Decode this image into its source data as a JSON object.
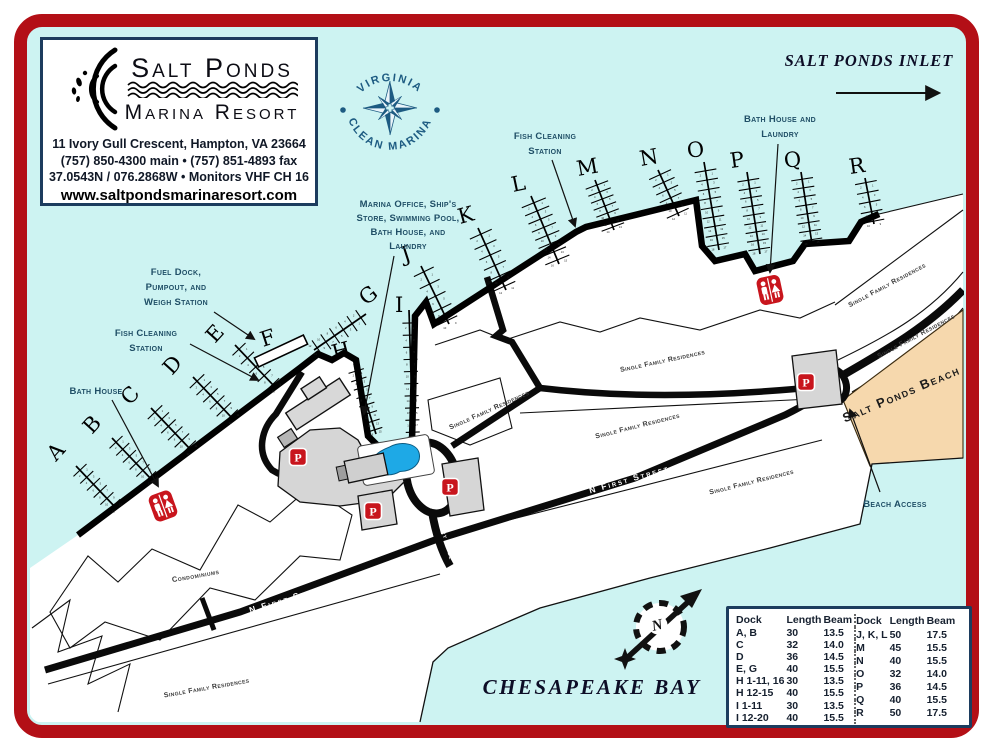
{
  "colors": {
    "frame_red": "#b30f16",
    "navy_border": "#1c3c5e",
    "water": "#cdf3f2",
    "label_blue": "#1f4e66",
    "beach_tan": "#f6d8ad",
    "clean_marina_blue": "#1d5b82",
    "icon_red": "#c8151d",
    "pool_blue": "#1ea9e6"
  },
  "logo_box": {
    "name_line1": "Salt Ponds",
    "name_line2": "Marina Resort",
    "address": "11 Ivory Gull Crescent, Hampton, VA  23664",
    "phone": "(757) 850-4300 main • (757) 851-4893 fax",
    "coordinates": "37.0543N / 076.2868W • Monitors VHF CH 16",
    "website": "www.saltpondsmarinaresort.com"
  },
  "clean_marina": {
    "arc_top": "VIRGINIA",
    "arc_bottom": "CLEAN MARINA"
  },
  "sea_labels": {
    "inlet": "SALT PONDS INLET",
    "bay": "CHESAPEAKE BAY",
    "compass_north": "N"
  },
  "annotations": {
    "fish_cleaning_line1": "Fish Cleaning",
    "fish_cleaning_line2": "Station",
    "bath_laundry_line1": "Bath House and",
    "bath_laundry_line2": "Laundry",
    "marina_office_line1": "Marina Office, Ship's",
    "marina_office_line2": "Store, Swimming Pool,",
    "marina_office_line3": "Bath House, and",
    "marina_office_line4": "Laundry",
    "fuel_line1": "Fuel Dock,",
    "fuel_line2": "Pumpout, and",
    "fuel_line3": "Weigh Station",
    "bath_house": "Bath House",
    "beach_access": "Beach Access"
  },
  "area_labels": {
    "beach": "Salt Ponds Beach",
    "condominiums": "Condominiums",
    "single_family": "Single Family Residences",
    "n_first_street": "N First Street",
    "ivory_gull": "Ivory Gull"
  },
  "icons": {
    "parking_label": "P"
  },
  "docks": [
    {
      "id": "A",
      "slips": 12
    },
    {
      "id": "B",
      "slips": 12
    },
    {
      "id": "C",
      "slips": 12
    },
    {
      "id": "D",
      "slips": 12
    },
    {
      "id": "E",
      "slips": 10
    },
    {
      "id": "F",
      "slips": 0
    },
    {
      "id": "G",
      "slips": 12
    },
    {
      "id": "H",
      "slips": 16
    },
    {
      "id": "I",
      "slips": 20
    },
    {
      "id": "J",
      "slips": 10
    },
    {
      "id": "K",
      "slips": 12
    },
    {
      "id": "L",
      "slips": 16
    },
    {
      "id": "M",
      "slips": 14
    },
    {
      "id": "N",
      "slips": 12
    },
    {
      "id": "O",
      "slips": 18
    },
    {
      "id": "P",
      "slips": 18
    },
    {
      "id": "Q",
      "slips": 16
    },
    {
      "id": "R",
      "slips": 10
    }
  ],
  "slip_table": {
    "headers": [
      "Dock",
      "Length",
      "Beam"
    ],
    "left_rows": [
      [
        "A, B",
        "30",
        "13.5"
      ],
      [
        "C",
        "32",
        "14.0"
      ],
      [
        "D",
        "36",
        "14.5"
      ],
      [
        "E, G",
        "40",
        "15.5"
      ],
      [
        "H 1-11, 16",
        "30",
        "13.5"
      ],
      [
        "H 12-15",
        "40",
        "15.5"
      ],
      [
        "I 1-11",
        "30",
        "13.5"
      ],
      [
        "I 12-20",
        "40",
        "15.5"
      ]
    ],
    "right_rows": [
      [
        "J, K, L",
        "50",
        "17.5"
      ],
      [
        "M",
        "45",
        "15.5"
      ],
      [
        "N",
        "40",
        "15.5"
      ],
      [
        "O",
        "32",
        "14.0"
      ],
      [
        "P",
        "36",
        "14.5"
      ],
      [
        "Q",
        "40",
        "15.5"
      ],
      [
        "R",
        "50",
        "17.5"
      ]
    ]
  }
}
